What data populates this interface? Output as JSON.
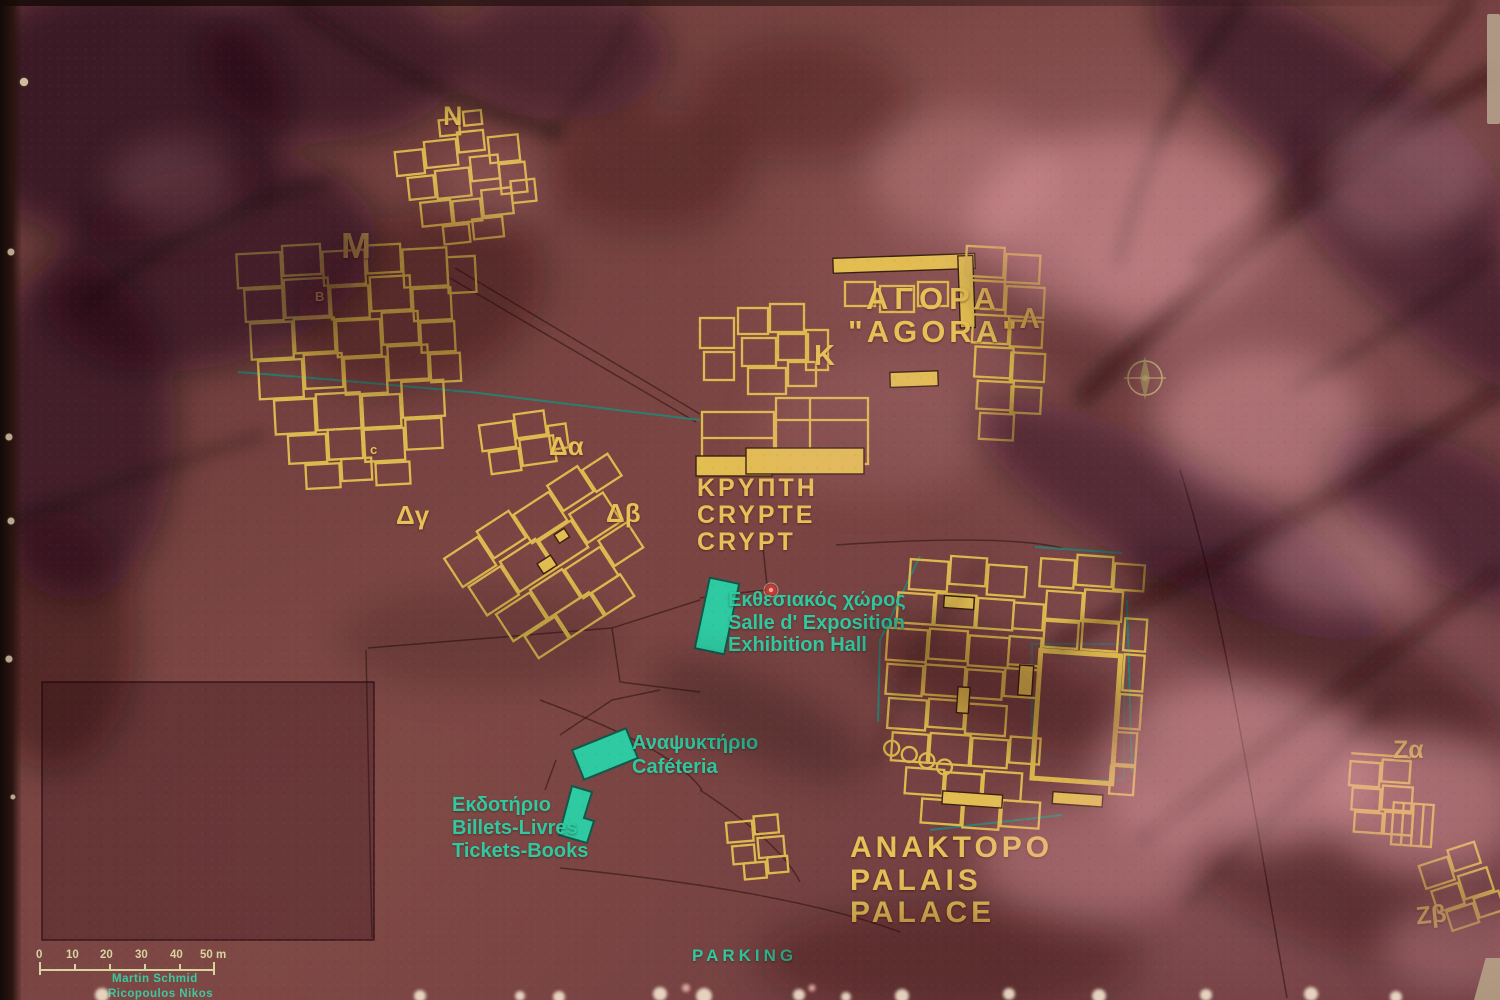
{
  "sectors": {
    "n": "N",
    "m": "M",
    "b": "B",
    "c": "c",
    "k": "K",
    "lambda": "Λ",
    "delta_alpha": "Δα",
    "delta_beta": "Δβ",
    "delta_gamma": "Δγ",
    "zeta_alpha": "Ζα",
    "zeta_beta": "Ζβ"
  },
  "agora": {
    "label_el": "ΑΓΟΡΑ",
    "label_translit": "\"AGORA\""
  },
  "crypt": {
    "label_el": "ΚΡΥΠΤΗ",
    "label_fr": "CRYPTE",
    "label_en": "CRYPT"
  },
  "palace": {
    "label_el": "ΑΝΑΚΤΟΡΟ",
    "label_fr": "PALAIS",
    "label_en": "PALACE"
  },
  "exhibition_hall": {
    "label_el": "Εκθεσιακός χώρος",
    "label_fr": "Salle d' Exposition",
    "label_en": "Exhibition Hall"
  },
  "cafeteria": {
    "label_el": "Αναψυκτήριο",
    "label_fr": "Caféteria"
  },
  "ticket_office": {
    "label_el": "Εκδοτήριο",
    "label_fr": "Billets-Livres",
    "label_en": "Tickets-Books"
  },
  "parking": {
    "label": "PARKING"
  },
  "scale_bar": {
    "ticks": [
      "0",
      "10",
      "20",
      "30",
      "40",
      "50 m"
    ]
  },
  "credits": {
    "line1": "Martin Schmid",
    "line2": "Ricopoulos Nikos"
  },
  "colors": {
    "board_maroon": "#713f3d",
    "plan_yellow": "#e2bd52",
    "label_green": "#2fc9a0",
    "teal_line": "#1e8a78",
    "marker_red": "#c53a2e",
    "scale_text": "#d8d3a0"
  }
}
